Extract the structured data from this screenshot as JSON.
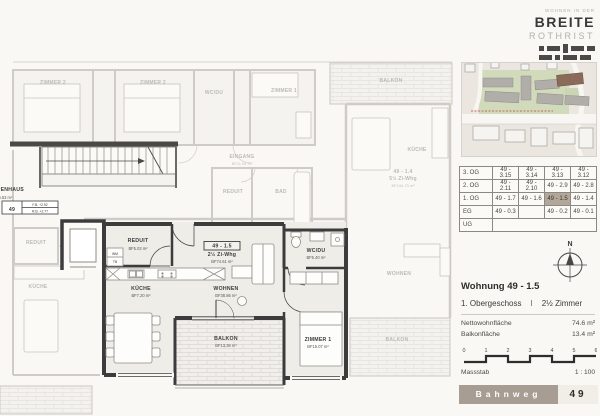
{
  "logo": {
    "tagline": "WOHNEN IN DER",
    "title": "BREITE",
    "subtitle": "ROTHRIST"
  },
  "sidebar": {
    "table": {
      "rows": [
        {
          "floor": "3. OG",
          "units": [
            "49 - 3.15",
            "49 - 3.14",
            "49 - 3.13",
            "49 - 3.12"
          ]
        },
        {
          "floor": "2. OG",
          "units": [
            "49 - 2.11",
            "49 - 2.10",
            "49 - 2.9",
            "49 - 2.8"
          ]
        },
        {
          "floor": "1. OG",
          "units": [
            "49 - 1.7",
            "49 - 1.6",
            "49 - 1.5",
            "49 - 1.4"
          ],
          "highlight": "49 - 1.5"
        },
        {
          "floor": "EG",
          "units": [
            "49 - 0.3",
            "",
            "49 - 0.2",
            "49 - 0.1"
          ]
        },
        {
          "floor": "UG",
          "merged": true
        }
      ]
    },
    "compass_label": "N",
    "unit_info": {
      "title": "Wohnung 49 - 1.5",
      "floor_line": "1. Obergeschoss",
      "separator": "I",
      "rooms_line": "2½ Zimmer",
      "areas": [
        {
          "label": "Nettowohnfläche",
          "value": "74.6 m²"
        },
        {
          "label": "Balkonfläche",
          "value": "13.4 m²"
        }
      ]
    },
    "scalebar": {
      "ticks": [
        "0",
        "1",
        "2",
        "3",
        "4",
        "5",
        "6"
      ],
      "label": "Massstab",
      "ratio": "1 : 100"
    },
    "address": {
      "street": "Bahnweg",
      "number": "49"
    }
  },
  "plan": {
    "labels": [
      {
        "x": 138,
        "y": 242,
        "t": "REDUIT",
        "cls": "d"
      },
      {
        "x": 138,
        "y": 250,
        "t": "BF5.03 m²",
        "cls": "da"
      },
      {
        "x": 141,
        "y": 290,
        "t": "KÜCHE",
        "cls": "d"
      },
      {
        "x": 141,
        "y": 297,
        "t": "BF7.20 m²",
        "cls": "da"
      },
      {
        "x": 226,
        "y": 290,
        "t": "WOHNEN",
        "cls": "d"
      },
      {
        "x": 226,
        "y": 297,
        "t": "BF38.86 m²",
        "cls": "da"
      },
      {
        "x": 316,
        "y": 252,
        "t": "WC/DU",
        "cls": "d"
      },
      {
        "x": 316,
        "y": 259,
        "t": "BF5.40 m²",
        "cls": "da"
      },
      {
        "x": 318,
        "y": 341,
        "t": "ZIMMER 1",
        "cls": "d"
      },
      {
        "x": 318,
        "y": 348,
        "t": "BF15.07 m²",
        "cls": "da"
      },
      {
        "x": 226,
        "y": 340,
        "t": "BALKON",
        "cls": "d"
      },
      {
        "x": 226,
        "y": 347,
        "t": "BF13.36 m²",
        "cls": "da"
      },
      {
        "x": 222,
        "y": 247.5,
        "t": "49 - 1.5",
        "cls": "d"
      },
      {
        "x": 222,
        "y": 256,
        "t": "2½ Zi-Whg",
        "cls": "d"
      },
      {
        "x": 222,
        "y": 263,
        "t": "BF74.61 m²",
        "cls": "da"
      },
      {
        "x": 3,
        "y": 191,
        "t": "TREPPENHAUS",
        "cls": "d",
        "a": "start"
      },
      {
        "x": 3,
        "y": 199,
        "t": "F24.53 m²",
        "cls": "da",
        "a": "start"
      },
      {
        "x": 12,
        "y": 211,
        "t": "49",
        "cls": "d"
      },
      {
        "x": 40,
        "y": 206,
        "t": "F.B. +2.92",
        "cls": "t"
      },
      {
        "x": 40,
        "y": 212.5,
        "t": "R.B. +2.77",
        "cls": "t"
      },
      {
        "x": 115,
        "y": 255,
        "t": "WM",
        "cls": "t"
      },
      {
        "x": 115,
        "y": 263,
        "t": "TB",
        "cls": "t"
      },
      {
        "x": 53,
        "y": 84,
        "t": "ZIMMER 2",
        "cls": "f"
      },
      {
        "x": 153,
        "y": 84,
        "t": "ZIMMER 2",
        "cls": "f"
      },
      {
        "x": 214,
        "y": 94,
        "t": "WC/DU",
        "cls": "f"
      },
      {
        "x": 284,
        "y": 92,
        "t": "ZIMMER 1",
        "cls": "f"
      },
      {
        "x": 391,
        "y": 82,
        "t": "BALKON",
        "cls": "f"
      },
      {
        "x": 242,
        "y": 158,
        "t": "EINGANG",
        "cls": "f"
      },
      {
        "x": 242,
        "y": 165,
        "t": "BF11.94 m²",
        "cls": "fa"
      },
      {
        "x": 233,
        "y": 193,
        "t": "REDUIT",
        "cls": "f"
      },
      {
        "x": 281,
        "y": 193,
        "t": "BAD",
        "cls": "f"
      },
      {
        "x": 417,
        "y": 151,
        "t": "KÜCHE",
        "cls": "f"
      },
      {
        "x": 403,
        "y": 173,
        "t": "49 - 1.4",
        "cls": "f"
      },
      {
        "x": 403,
        "y": 180,
        "t": "5½ Zi-Whg",
        "cls": "f"
      },
      {
        "x": 403,
        "y": 187,
        "t": "BF106.73 m²",
        "cls": "fa"
      },
      {
        "x": 36,
        "y": 244,
        "t": "REDUIT",
        "cls": "f"
      },
      {
        "x": 38,
        "y": 288,
        "t": "KÜCHE",
        "cls": "f"
      },
      {
        "x": 399,
        "y": 275,
        "t": "WOHNEN",
        "cls": "f"
      },
      {
        "x": 397,
        "y": 341,
        "t": "BALKON",
        "cls": "f"
      }
    ]
  },
  "colors": {
    "wall_dark": "#3c3c3c",
    "wall_faded": "#cfccc7",
    "highlight_cell": "#b3a799",
    "address_bar": "#a79d92",
    "highlight_building": "#8c6a59"
  }
}
